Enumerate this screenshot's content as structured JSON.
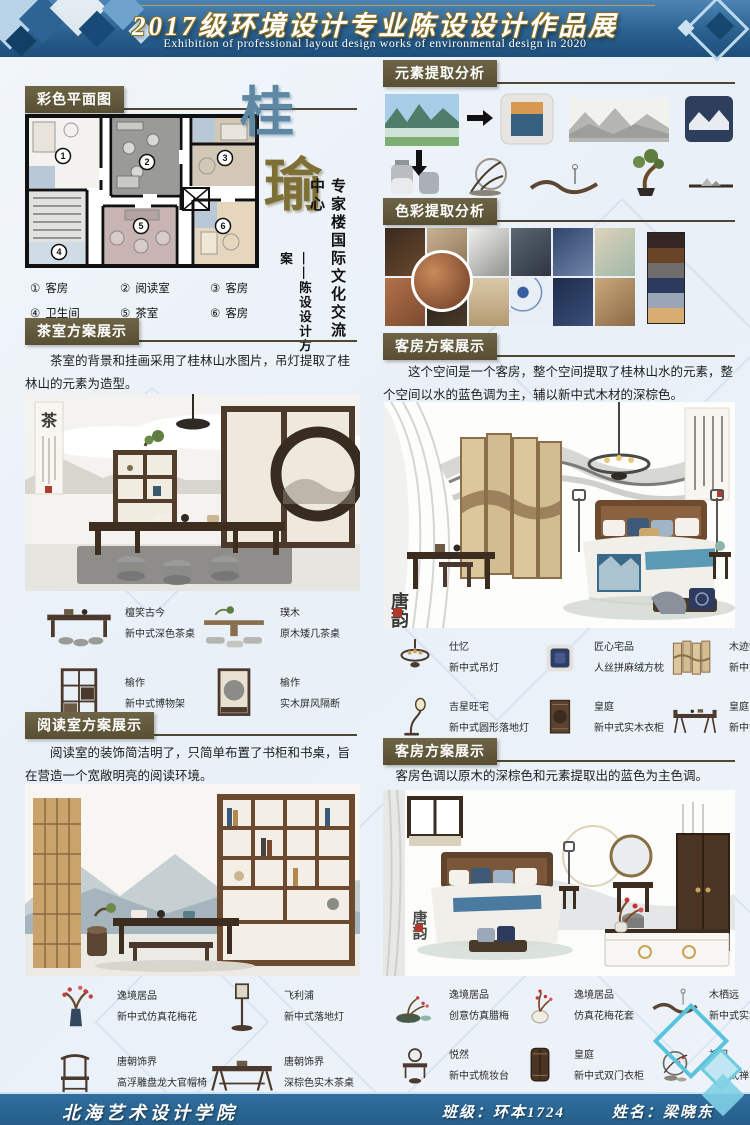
{
  "header": {
    "title": "2017级环境设计专业陈设设计作品展",
    "subtitle": "Exhibition of professional layout design works of environmental design in 2020"
  },
  "plan": {
    "section_label": "彩色平面图",
    "room_numbers": [
      "1",
      "2",
      "3",
      "4",
      "5",
      "6"
    ],
    "legend": [
      {
        "num": "①",
        "label": "客房"
      },
      {
        "num": "②",
        "label": "阅读室"
      },
      {
        "num": "③",
        "label": "客房"
      },
      {
        "num": "④",
        "label": "卫生间"
      },
      {
        "num": "⑤",
        "label": "茶室"
      },
      {
        "num": "⑥",
        "label": "客房"
      }
    ]
  },
  "title_art": {
    "char1": "桂",
    "char2": "瑜",
    "line1": "专家楼国际文化交流中心",
    "line2": "——陈设设计方案"
  },
  "element_analysis": {
    "section_label": "元素提取分析"
  },
  "color_analysis": {
    "section_label": "色彩提取分析",
    "palette": [
      "#332624",
      "#6a4426",
      "#6f6e6c",
      "#2b3a5e",
      "#9aa6b7",
      "#d9ac72"
    ]
  },
  "tea_room": {
    "section_label": "茶室方案展示",
    "desc": "茶室的背景和挂画采用了桂林山水图片，吊灯提取了桂林山的元素为造型。",
    "scene_char": "茶",
    "items": [
      {
        "brand": "檀笑古今",
        "name": "新中式深色茶桌"
      },
      {
        "brand": "璞木",
        "name": "原木矮几茶桌"
      },
      {
        "brand": "榆作",
        "name": "新中式博物架"
      },
      {
        "brand": "榆作",
        "name": "实木屏风隔断"
      }
    ]
  },
  "guest_room1": {
    "section_label": "客房方案展示",
    "desc": "这个空间是一个客房，整个空间提取了桂林山水的元素，整个空间以水的蓝色调为主，辅以新中式木材的深棕色。",
    "scene_seal": "唐韵",
    "items": [
      {
        "brand": "仕忆",
        "name": "新中式吊灯"
      },
      {
        "brand": "匠心宅品",
        "name": "人丝拼麻绒方枕"
      },
      {
        "brand": "木迹制品",
        "name": "新中式楠木屏风"
      },
      {
        "brand": "吉星旺宅",
        "name": "新中式圆形落地灯"
      },
      {
        "brand": "皇庭",
        "name": "新中式实木衣柜"
      },
      {
        "brand": "皇庭",
        "name": "新中式书桌"
      }
    ]
  },
  "reading_room": {
    "section_label": "阅读室方案展示",
    "desc": "阅读室的装饰简洁明了，只简单布置了书柜和书桌，旨在营造一个宽敞明亮的阅读环境。",
    "items": [
      {
        "brand": "逸境居品",
        "name": "新中式仿真花梅花"
      },
      {
        "brand": "飞利浦",
        "name": "新中式落地灯"
      },
      {
        "brand": "唐朝饰界",
        "name": "高浮雕盘龙大官帽椅"
      },
      {
        "brand": "唐朝饰界",
        "name": "深棕色实木茶桌"
      }
    ]
  },
  "guest_room2": {
    "section_label": "客房方案展示",
    "desc": "客房色调以原木的深棕色和元素提取出的蓝色为主色调。",
    "scene_seal": "唐韵",
    "items": [
      {
        "brand": "逸境居品",
        "name": "创意仿真腊梅"
      },
      {
        "brand": "逸境居品",
        "name": "仿真花梅花套"
      },
      {
        "brand": "木栖远",
        "name": "新中式实木吊灯"
      },
      {
        "brand": "悦然",
        "name": "新中式梳妆台"
      },
      {
        "brand": "皇庭",
        "name": "新中式双门衣柜"
      },
      {
        "brand": "初见",
        "name": "新中式禅意插花摆件"
      }
    ]
  },
  "footer": {
    "school": "北海艺术设计学院",
    "class_label": "班级：环本1724",
    "name_label": "姓名：梁晓东"
  }
}
